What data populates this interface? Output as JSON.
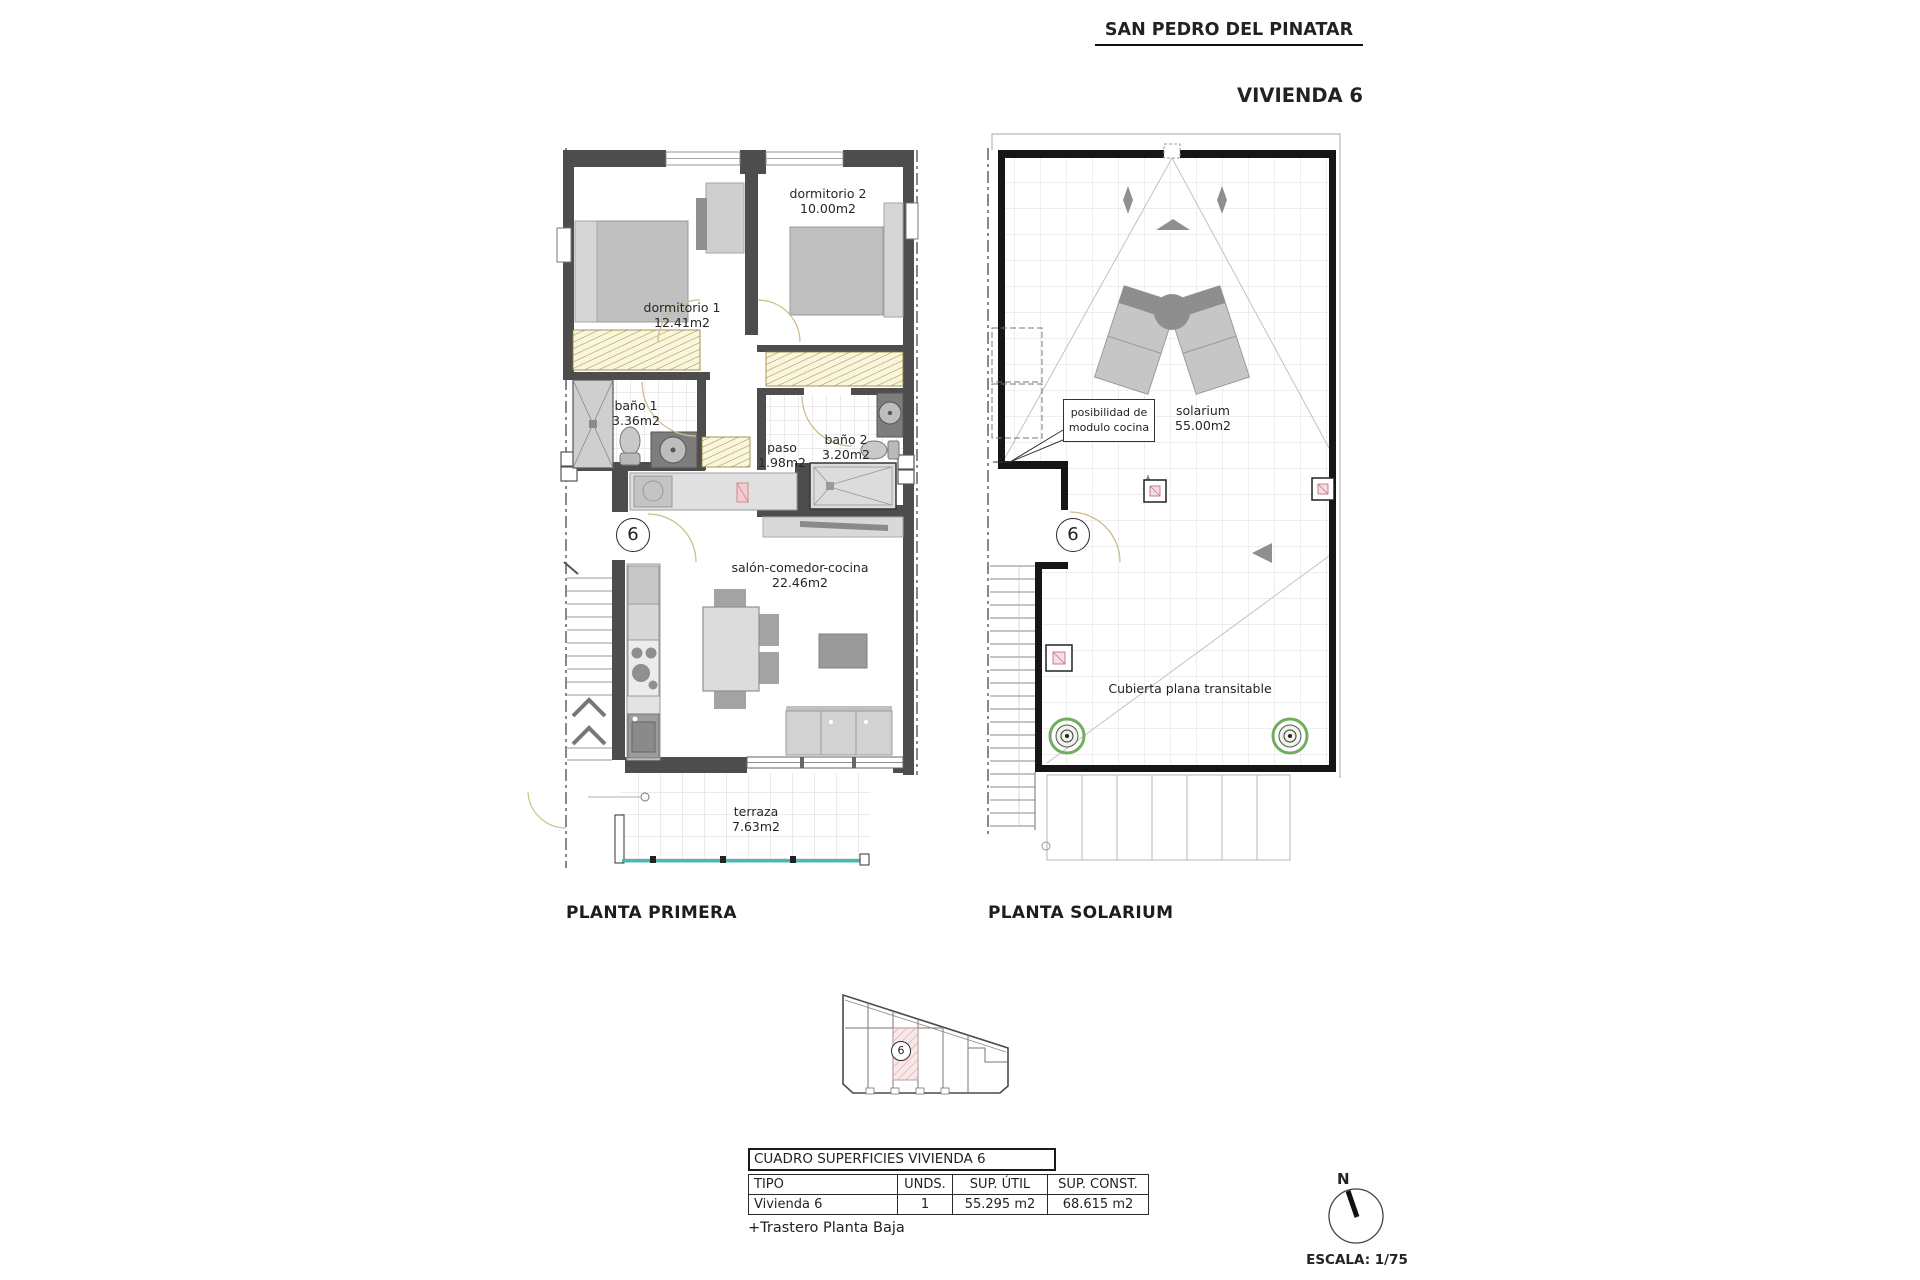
{
  "header": {
    "location": "SAN PEDRO DEL PINATAR",
    "unit_title": "VIVIENDA 6"
  },
  "floor1": {
    "label": "PLANTA PRIMERA",
    "unit_number": "6",
    "rooms": {
      "dormitorio2": {
        "name": "dormitorio 2",
        "area": "10.00m2"
      },
      "dormitorio1": {
        "name": "dormitorio 1",
        "area": "12.41m2"
      },
      "bano1": {
        "name": "baño 1",
        "area": "3.36m2"
      },
      "paso": {
        "name": "paso",
        "area": "1.98m2"
      },
      "bano2": {
        "name": "baño 2",
        "area": "3.20m2"
      },
      "salon": {
        "name": "salón-comedor-cocina",
        "area": "22.46m2"
      },
      "terraza": {
        "name": "terraza",
        "area": "7.63m2"
      }
    }
  },
  "solarium_floor": {
    "label": "PLANTA SOLARIUM",
    "unit_number": "6",
    "rooms": {
      "solarium": {
        "name": "solarium",
        "area": "55.00m2"
      }
    },
    "annotations": {
      "kitchen_module_line1": "posibilidad de",
      "kitchen_module_line2": "modulo cocina",
      "roof": "Cubierta plana transitable"
    }
  },
  "site_plan": {
    "unit_number": "6"
  },
  "table": {
    "title": "CUADRO SUPERFICIES VIVIENDA 6",
    "columns": [
      "TIPO",
      "UNDS.",
      "SUP. ÚTIL",
      "SUP. CONST."
    ],
    "rows": [
      [
        "Vivienda 6",
        "1",
        "55.295 m2",
        "68.615 m2"
      ]
    ],
    "footnote": "+Trastero Planta Baja"
  },
  "compass": {
    "north": "N"
  },
  "scale": {
    "label": "ESCALA: 1/75"
  }
}
